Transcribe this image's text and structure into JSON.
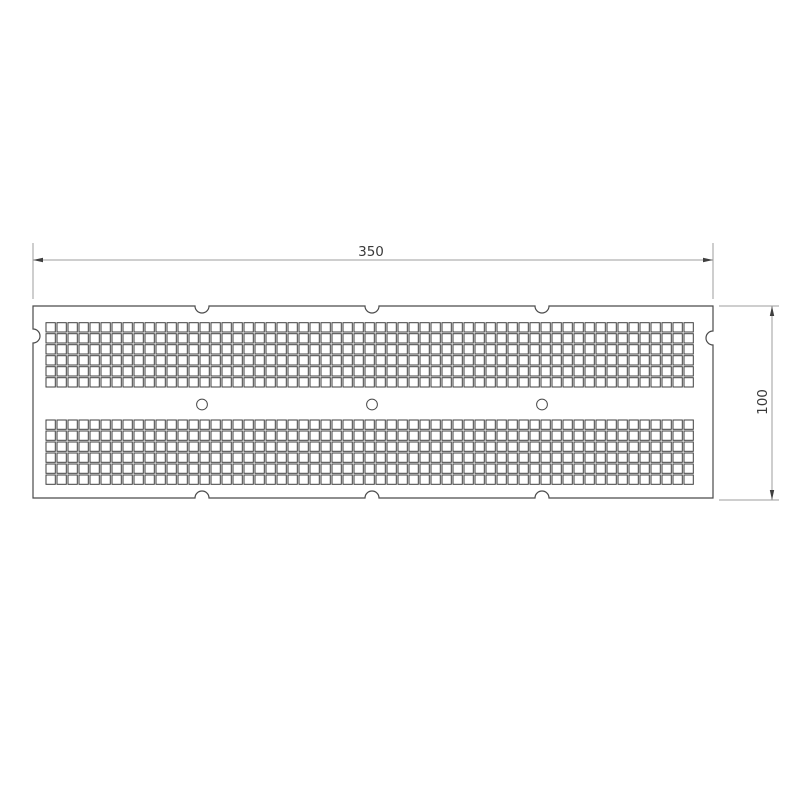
{
  "dimensions": {
    "width": {
      "label": "350"
    },
    "height": {
      "label": "100"
    }
  },
  "colors": {
    "background": "#ffffff",
    "plate_outline": "#4a4a4a",
    "perforation_stroke": "#3f3f3f",
    "hole_stroke": "#4a4a4a",
    "dimension_line": "#9e9e9e",
    "arrow_fill": "#3f3f3f",
    "text": "#3a3a3a"
  },
  "drawing": {
    "plate": {
      "x": 33,
      "y": 306,
      "width": 680,
      "height": 192
    },
    "notches": {
      "radius": 7,
      "top_x": [
        202,
        372,
        542
      ],
      "bottom_x": [
        202,
        372,
        542
      ],
      "left_y": 336,
      "right_y": 338
    },
    "grid": {
      "origin_x": 46,
      "pitch": 11,
      "cell": 9.3,
      "columns": 59,
      "rows_per_band": 6,
      "band_y": [
        322.7,
        420
      ]
    },
    "holes": {
      "cx": [
        202,
        372,
        542
      ],
      "cy": 404.5,
      "radius": 5.4
    },
    "width_dim": {
      "ext_x": [
        33,
        713
      ],
      "ext_y1": 243,
      "ext_y2": 299,
      "line_y": 260,
      "x1": 33,
      "x2": 713
    },
    "height_dim": {
      "ext_y": [
        306,
        500
      ],
      "ext_x1": 719,
      "ext_x2": 779,
      "line_x": 772,
      "y1": 306,
      "y2": 500
    },
    "arrow": {
      "length": 10,
      "half_width": 2.2
    }
  }
}
